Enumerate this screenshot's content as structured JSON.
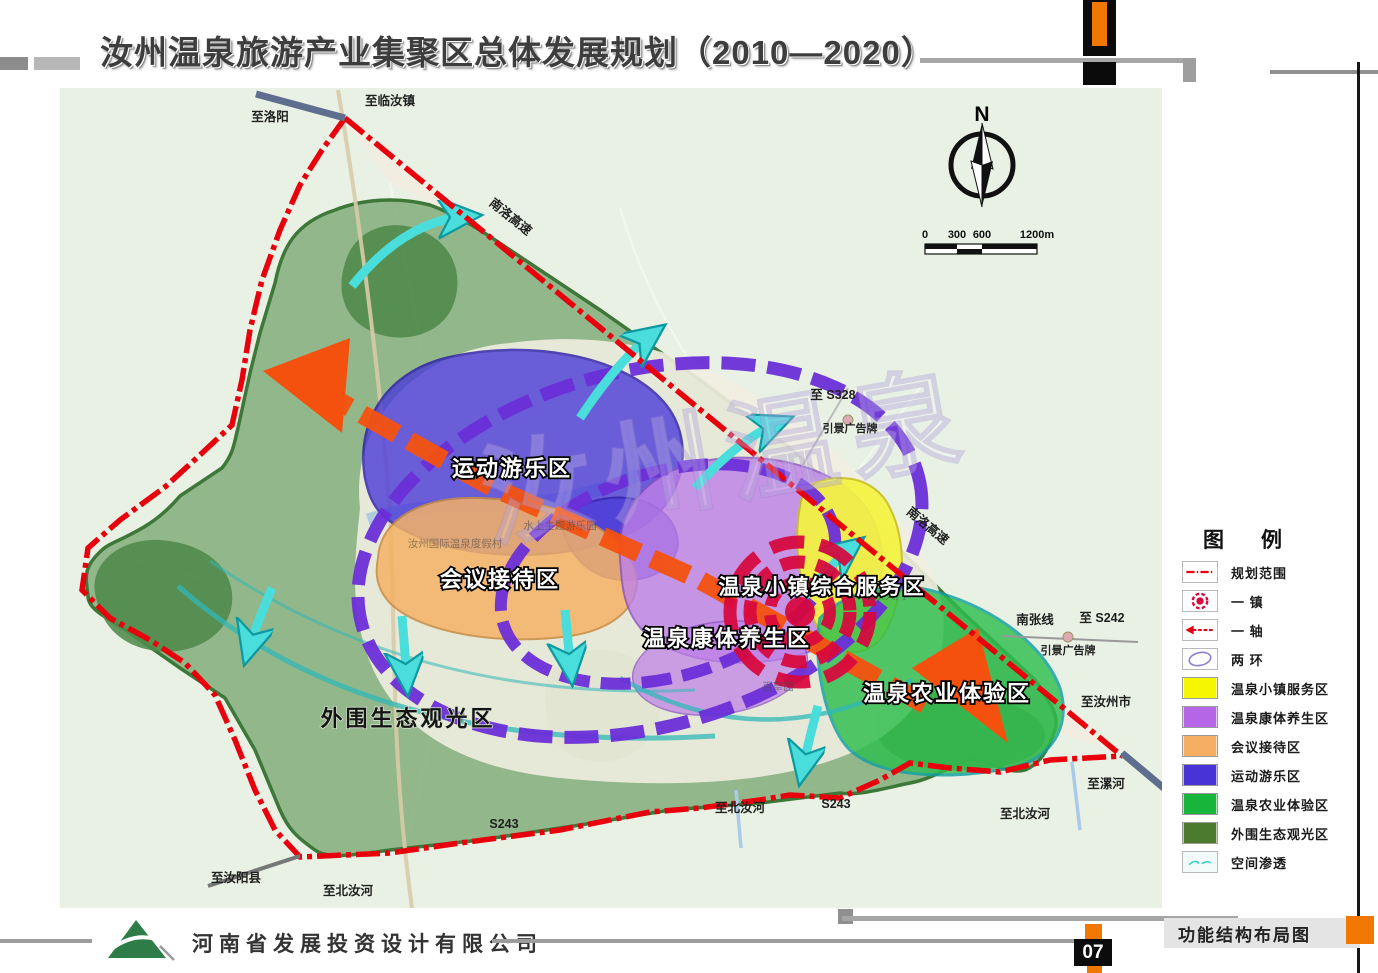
{
  "header": {
    "title": "汝州温泉旅游产业集聚区总体发展规划（2010—2020）"
  },
  "footer": {
    "company": "河南省发展投资设计有限公司",
    "caption": "功能结构布局图",
    "page": "07"
  },
  "compass": {
    "north_label": "N"
  },
  "scale_bar": {
    "ticks": [
      "0",
      "300",
      "600",
      "1200m"
    ]
  },
  "legend": {
    "title": "图　例",
    "items": [
      {
        "label": "规划范围",
        "type": "boundary-line",
        "color": "#e60012"
      },
      {
        "label": "一  镇",
        "type": "town-symbol",
        "color": "#d8073d"
      },
      {
        "label": "一  轴",
        "type": "axis-arrow",
        "color": "#e60012"
      },
      {
        "label": "两  环",
        "type": "ring",
        "color": "#8f7fd8"
      },
      {
        "label": "温泉小镇服务区",
        "type": "swatch",
        "color": "#f6f600"
      },
      {
        "label": "温泉康体养生区",
        "type": "swatch",
        "color": "#b466e6"
      },
      {
        "label": "会议接待区",
        "type": "swatch",
        "color": "#f6ae63"
      },
      {
        "label": "运动游乐区",
        "type": "swatch",
        "color": "#4733d6"
      },
      {
        "label": "温泉农业体验区",
        "type": "swatch",
        "color": "#17b53a"
      },
      {
        "label": "外围生态观光区",
        "type": "swatch",
        "color": "#4c7a2e"
      },
      {
        "label": "空间渗透",
        "type": "penetration",
        "color": "#35ccd4"
      }
    ]
  },
  "map": {
    "watermark": "汝州温泉",
    "zones": [
      {
        "label": "运动游乐区"
      },
      {
        "label": "会议接待区"
      },
      {
        "label": "温泉小镇综合服务区"
      },
      {
        "label": "温泉康体养生区"
      },
      {
        "label": "温泉农业体验区"
      },
      {
        "label": "外围生态观光区"
      }
    ],
    "roads": [
      {
        "label": "至洛阳"
      },
      {
        "label": "至临汝镇"
      },
      {
        "label": "南洛高速"
      },
      {
        "label": "至 S328"
      },
      {
        "label": "引景广告牌"
      },
      {
        "label": "南洛高速"
      },
      {
        "label": "南张线"
      },
      {
        "label": "至 S242"
      },
      {
        "label": "引景广告牌"
      },
      {
        "label": "至汝州市"
      },
      {
        "label": "至漯河"
      },
      {
        "label": "至北汝河"
      },
      {
        "label": "S243"
      },
      {
        "label": "至北汝河"
      },
      {
        "label": "S243"
      },
      {
        "label": "至北汝河"
      },
      {
        "label": "至汝阳县"
      }
    ],
    "pois": [
      {
        "label": "汝州国际温泉度假村"
      },
      {
        "label": "水上主题游乐园"
      },
      {
        "label": "温泉大门"
      },
      {
        "label": "百草园"
      }
    ]
  }
}
